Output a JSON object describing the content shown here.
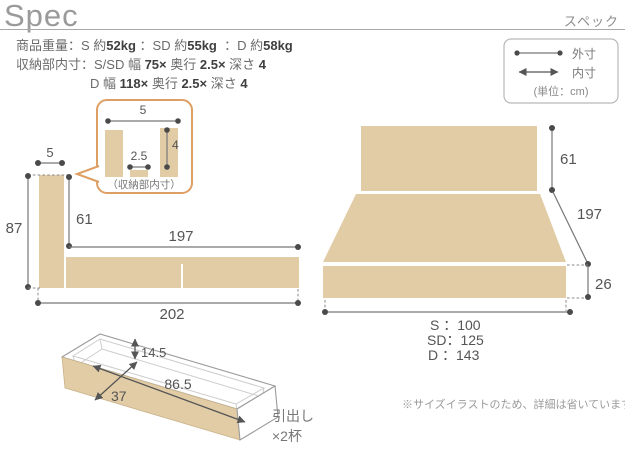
{
  "header": {
    "title": "Spec",
    "subtitle": "スペック"
  },
  "specs": {
    "lines": [
      {
        "indent": 0,
        "segments": [
          {
            "text": "商品重量：S 約",
            "bold": false
          },
          {
            "text": "52kg",
            "bold": true
          },
          {
            "text": " ：SD 約",
            "bold": false
          },
          {
            "text": "55kg",
            "bold": true
          },
          {
            "text": "  ：D 約",
            "bold": false
          },
          {
            "text": "58kg",
            "bold": true
          }
        ]
      },
      {
        "indent": 0,
        "segments": [
          {
            "text": "収納部内寸：S/SD 幅 ",
            "bold": false
          },
          {
            "text": "75×",
            "bold": true
          },
          {
            "text": " 奥行 ",
            "bold": false
          },
          {
            "text": "2.5×",
            "bold": true
          },
          {
            "text": " 深さ ",
            "bold": false
          },
          {
            "text": "4",
            "bold": true
          }
        ]
      },
      {
        "indent": 74,
        "segments": [
          {
            "text": "D 幅 ",
            "bold": false
          },
          {
            "text": "118×",
            "bold": true
          },
          {
            "text": " 奥行 ",
            "bold": false
          },
          {
            "text": "2.5×",
            "bold": true
          },
          {
            "text": " 深さ ",
            "bold": false
          },
          {
            "text": "4",
            "bold": true
          }
        ]
      }
    ]
  },
  "legend": {
    "outer_label": "外寸",
    "inner_label": "内寸",
    "unit": "(単位：cm)"
  },
  "side_view": {
    "headboard_thickness": "5",
    "total_height": "87",
    "headboard_above_base": "61",
    "base_length": "197",
    "total_length": "202",
    "callout": {
      "width": "5",
      "slot_width": "2.5",
      "slot_depth": "4",
      "caption": "（収納部内寸）"
    }
  },
  "front_view": {
    "headboard_height": "61",
    "depth": "197",
    "base_height": "26",
    "width_s": "S ：100",
    "width_sd": "SD：125",
    "width_d": "D ：143"
  },
  "drawer": {
    "inner_height": "14.5",
    "inner_width": "37",
    "inner_length": "86.5",
    "caption_line1": "引出し",
    "caption_line2": "×2杯"
  },
  "note": "※サイズイラストのため、詳細は省いています。",
  "colors": {
    "wood": "#e1cca5",
    "line": "#777777",
    "dot": "#4a4a4a",
    "callout_border": "#dd9f63"
  }
}
